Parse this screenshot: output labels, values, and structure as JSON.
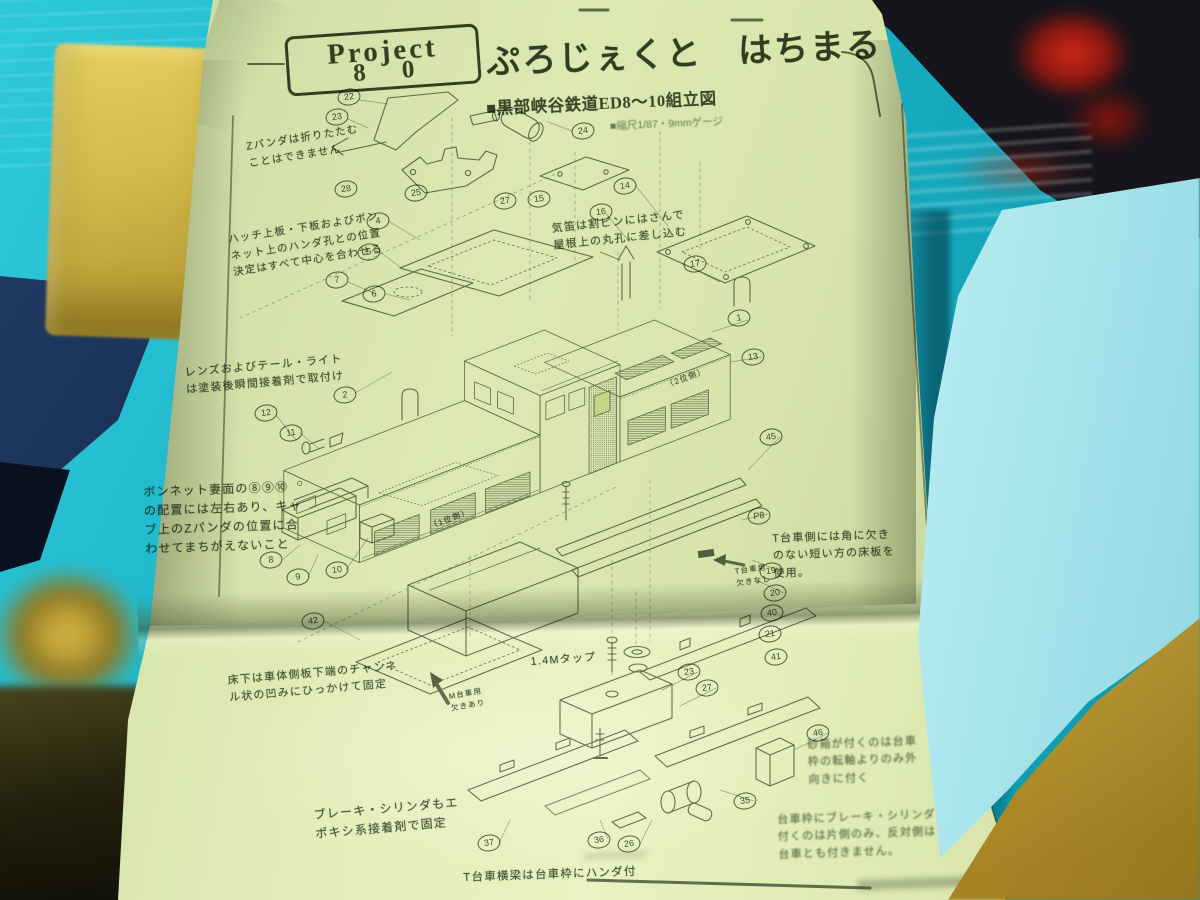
{
  "photo": {
    "background_color": "#18b4c8",
    "paper_color": "#d8e3ac",
    "ink_color": "#4a5342",
    "foam_left_color": "#d3ba49",
    "foam_right_color": "#b2e9f0",
    "foam_bottom_right_color": "#c6a136",
    "packing_box_color": "#16294a",
    "red_object_color": "#c62014"
  },
  "document": {
    "logo": {
      "line1": "Project",
      "line2": "8 0"
    },
    "title": "ぷろじぇくと　はちまる",
    "subtitle": "■黒部峡谷鉄道ED8～10組立図",
    "scale_note": "■縮尺1/87・9mmゲージ",
    "annotations": [
      {
        "id": "pantograph-note",
        "text": "Zパンダは折りたたむ\nことはできません",
        "x": 245,
        "y": 139,
        "rot": -9,
        "size": 10.5
      },
      {
        "id": "hatch-note",
        "text": "ハッチ上板・下板およびボン\nネット上のハンダ孔との位置\n決定はすべて中心を合わせる",
        "x": 227,
        "y": 232,
        "rot": -9,
        "size": 10.5
      },
      {
        "id": "whistle-note",
        "text": "気笛は割ピンにはさんで\n屋根上の丸孔に差し込む",
        "x": 551,
        "y": 221,
        "rot": -6,
        "size": 11
      },
      {
        "id": "lens-note",
        "text": "レンズおよびテール・ライト\nは塗装後瞬間接着剤で取付け",
        "x": 184,
        "y": 365,
        "rot": -5,
        "size": 11
      },
      {
        "id": "bonnet-note",
        "text": "ボンネット妻面の⑧⑨⑩\nの配置には左右あり、キャ\nブ上のZパンダの位置に合\nわせてまちがえないこと",
        "x": 143,
        "y": 483,
        "rot": -2,
        "size": 12
      },
      {
        "id": "t-bogie-floor-note",
        "text": "T台車側には角に欠き\nのない短い方の床板を\n使用。",
        "x": 772,
        "y": 531,
        "rot": -2,
        "size": 11
      },
      {
        "id": "t-bogie-tag",
        "text": "T台車用\n欠きなし",
        "x": 734,
        "y": 566,
        "rot": -8,
        "size": 7.5
      },
      {
        "id": "floor-note",
        "text": "床下は車体側板下端のチャンネ\nル状の凹みにひっかけて固定",
        "x": 227,
        "y": 673,
        "rot": -5,
        "size": 11
      },
      {
        "id": "m-bogie-tag",
        "text": "M台車用\n欠きあり",
        "x": 448,
        "y": 691,
        "rot": -10,
        "size": 7.5
      },
      {
        "id": "tap-note",
        "text": "1.4Mタップ",
        "x": 530,
        "y": 654,
        "rot": -4,
        "size": 11
      },
      {
        "id": "brake-note",
        "text": "ブレーキ・シリンダもエ\nポキシ系接着剤で固定",
        "x": 313,
        "y": 806,
        "rot": -5,
        "size": 12
      },
      {
        "id": "crossbeam-note",
        "text": "T台車横梁は台車枠にハンダ付",
        "x": 463,
        "y": 869,
        "rot": -2,
        "size": 11.5
      },
      {
        "id": "sandbox-note",
        "text": "砂箱が付くのは台車\n枠の転軸よりのみ外\n向きに付く",
        "x": 807,
        "y": 737,
        "rot": -2,
        "size": 11,
        "blur": true
      },
      {
        "id": "bogie-brake-note",
        "text": "台車枠にブレーキ・シリンダが\n付くのは片側のみ、反対側は\n台車とも付きません。",
        "x": 777,
        "y": 812,
        "rot": -2,
        "size": 11,
        "blur": true
      },
      {
        "id": "side-label-2",
        "text": "（2位側）",
        "x": 664,
        "y": 380,
        "rot": -20,
        "size": 8
      },
      {
        "id": "side-label-1",
        "text": "（1位側）",
        "x": 428,
        "y": 521,
        "rot": -20,
        "size": 8
      }
    ],
    "callouts": [
      {
        "label": "22",
        "x": 349,
        "y": 97
      },
      {
        "label": "23",
        "x": 337,
        "y": 117
      },
      {
        "label": "24",
        "x": 583,
        "y": 131
      },
      {
        "label": "25",
        "x": 416,
        "y": 193
      },
      {
        "label": "27",
        "x": 505,
        "y": 201
      },
      {
        "label": "15",
        "x": 539,
        "y": 199
      },
      {
        "label": "14",
        "x": 625,
        "y": 186
      },
      {
        "label": "16",
        "x": 601,
        "y": 212
      },
      {
        "label": "17",
        "x": 695,
        "y": 264
      },
      {
        "label": "4",
        "x": 378,
        "y": 221
      },
      {
        "label": "5",
        "x": 369,
        "y": 252
      },
      {
        "label": "7",
        "x": 337,
        "y": 280
      },
      {
        "label": "6",
        "x": 374,
        "y": 294
      },
      {
        "label": "28",
        "x": 346,
        "y": 189
      },
      {
        "label": "2",
        "x": 345,
        "y": 395
      },
      {
        "label": "12",
        "x": 266,
        "y": 413
      },
      {
        "label": "11",
        "x": 291,
        "y": 433
      },
      {
        "label": "1",
        "x": 739,
        "y": 318
      },
      {
        "label": "13",
        "x": 753,
        "y": 357
      },
      {
        "label": "45",
        "x": 771,
        "y": 437
      },
      {
        "label": "P8",
        "x": 759,
        "y": 516
      },
      {
        "label": "19",
        "x": 771,
        "y": 571
      },
      {
        "label": "20",
        "x": 775,
        "y": 593
      },
      {
        "label": "40",
        "x": 772,
        "y": 613
      },
      {
        "label": "21",
        "x": 770,
        "y": 634
      },
      {
        "label": "41",
        "x": 776,
        "y": 657
      },
      {
        "label": "8",
        "x": 271,
        "y": 560
      },
      {
        "label": "9",
        "x": 298,
        "y": 577
      },
      {
        "label": "10",
        "x": 337,
        "y": 570
      },
      {
        "label": "42",
        "x": 313,
        "y": 621
      },
      {
        "label": "23",
        "x": 689,
        "y": 672
      },
      {
        "label": "27",
        "x": 707,
        "y": 688
      },
      {
        "label": "37",
        "x": 489,
        "y": 843
      },
      {
        "label": "36",
        "x": 599,
        "y": 840
      },
      {
        "label": "26",
        "x": 629,
        "y": 844
      },
      {
        "label": "46",
        "x": 818,
        "y": 733
      },
      {
        "label": "35",
        "x": 745,
        "y": 801
      }
    ]
  }
}
